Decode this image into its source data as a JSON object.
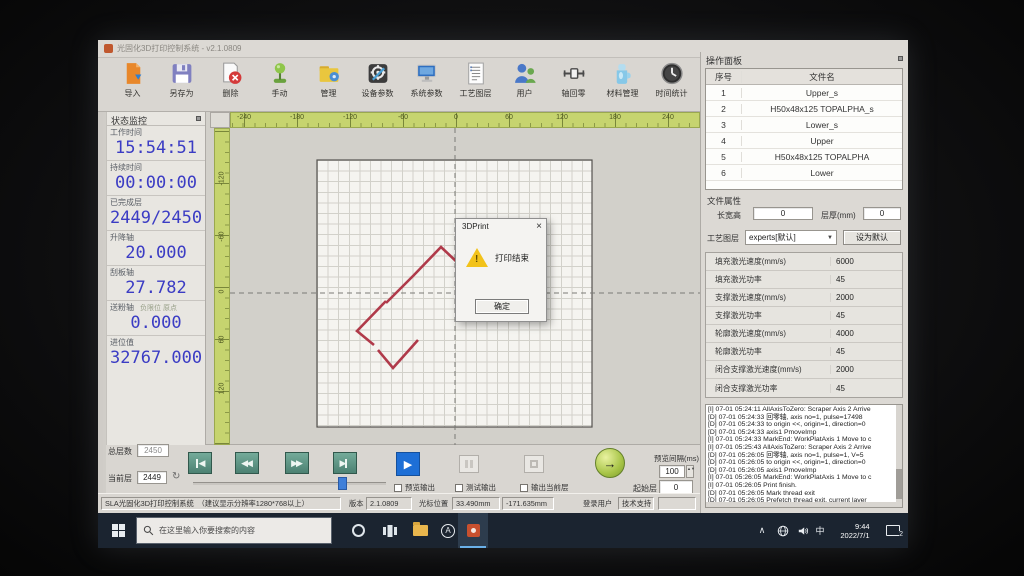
{
  "window": {
    "title": "光固化3D打印控制系统 - v2.1.0809"
  },
  "toolbar": {
    "items": [
      {
        "label": "导入"
      },
      {
        "label": "另存为"
      },
      {
        "label": "删除"
      },
      {
        "label": "手动"
      },
      {
        "label": "管理"
      },
      {
        "label": "设备参数"
      },
      {
        "label": "系统参数"
      },
      {
        "label": "工艺图层"
      },
      {
        "label": "用户"
      },
      {
        "label": "轴回零"
      },
      {
        "label": "材料管理"
      },
      {
        "label": "时间统计"
      }
    ]
  },
  "status_panel": {
    "title": "状态监控",
    "fields": [
      {
        "label": "工作时间",
        "value": "15:54:51"
      },
      {
        "label": "持续时间",
        "value": "00:00:00"
      },
      {
        "label": "已完成层",
        "value": "2449/2450"
      },
      {
        "label": "升降轴",
        "value": "20.000"
      },
      {
        "label": "刮板轴",
        "value": "27.782"
      },
      {
        "label": "送粉轴",
        "sub": "负限位 原点",
        "value": "0.000"
      },
      {
        "label": "进位值",
        "value": "32767.000"
      }
    ]
  },
  "canvas": {
    "ruler_x": [
      "-240",
      "-180",
      "-120",
      "-60",
      "0",
      "60",
      "120",
      "180",
      "240"
    ],
    "ruler_y": [
      "-120",
      "-60",
      "0",
      "60",
      "120"
    ]
  },
  "dialog": {
    "title": "3DPrint",
    "close": "×",
    "warn": "!",
    "message": "打印结束",
    "ok_label": "确定"
  },
  "op_panel": {
    "title": "操作面板",
    "table": {
      "col1": "序号",
      "col2": "文件名",
      "rows": [
        {
          "no": "1",
          "name": "Upper_s"
        },
        {
          "no": "2",
          "name": "H50x48x125 TOPALPHA_s"
        },
        {
          "no": "3",
          "name": "Lower_s"
        },
        {
          "no": "4",
          "name": "Upper"
        },
        {
          "no": "5",
          "name": "H50x48x125 TOPALPHA"
        },
        {
          "no": "6",
          "name": "Lower"
        }
      ]
    },
    "props": {
      "title": "文件属性",
      "dim_label": "长宽高",
      "dim_value": "0",
      "thick_label": "层厚(mm)",
      "thick_value": "0"
    },
    "process": {
      "label": "工艺图层",
      "selected": "experts[默认]",
      "set_default": "设为默认"
    },
    "params": [
      {
        "name": "填充激光速度(mm/s)",
        "value": "6000"
      },
      {
        "name": "填充激光功率",
        "value": "45"
      },
      {
        "name": "支撑激光速度(mm/s)",
        "value": "2000"
      },
      {
        "name": "支撑激光功率",
        "value": "45"
      },
      {
        "name": "轮廓激光速度(mm/s)",
        "value": "4000"
      },
      {
        "name": "轮廓激光功率",
        "value": "45"
      },
      {
        "name": "闭合支撑激光速度(mm/s)",
        "value": "2000"
      },
      {
        "name": "闭合支撑激光功率",
        "value": "45"
      }
    ],
    "logs": [
      "[I] 07-01 05:24:11 AllAxisToZero: Scraper Axis 2 Arrive",
      "[D] 07-01 05:24:33 回零轴, axis no=1, pulse=17498",
      "[D] 07-01 05:24:33 to origin <<, origin=1, direction=0",
      "[D] 07-01 05:24:33 axis1 PmoveImp",
      "[I] 07-01 05:24:33 MarkEnd: WorkPlatAxis 1 Move to c",
      "[I] 07-01 05:25:43 AllAxisToZero: Scraper Axis 2 Arrive",
      "[D] 07-01 05:26:05 回零轴, axis no=1, pulse=1, V=5",
      "[D] 07-01 05:26:05 to origin <<, origin=1, direction=0",
      "[D] 07-01 05:26:05 axis1 PmoveImp",
      "[I] 07-01 05:26:05 MarkEnd: WorkPlatAxis 1 Move to c",
      "[I] 07-01 05:26:05 Print finish.",
      "[D] 07-01 05:26:05 Mark thread exit",
      "[D] 07-01 05:26:05 Prefetch thread exit, current layer"
    ]
  },
  "controls": {
    "total_label": "总层数",
    "total_value": "2450",
    "current_label": "当前层",
    "current_value": "2449",
    "cb_preview": "预览输出",
    "cb_test": "测试输出",
    "cb_current": "输出当前层",
    "start_label": "起始层",
    "start_value": "0",
    "interval_label": "预览间隔(ms)",
    "interval_value": "100"
  },
  "statusbar": {
    "app_name": "SLA光固化3D打印控制系统　（建议显示分辨率1280*768以上）",
    "version_label": "版本",
    "version": "2.1.0809",
    "cursor_label": "光标位置",
    "cursor_x": "33.490mm",
    "cursor_y": "-171.635mm",
    "user_label": "登录用户",
    "support_label": "技术支持"
  },
  "taskbar": {
    "search_placeholder": "在这里输入你要搜索的内容",
    "ime": "中",
    "time": "9:44",
    "date": "2022/7/1",
    "badge": "2"
  }
}
